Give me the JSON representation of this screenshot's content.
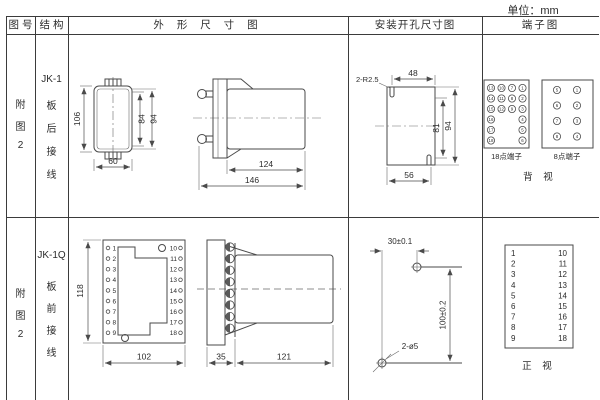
{
  "colors": {
    "line": "#3b3b3b",
    "drawing": "#4a4a4a",
    "text": "#2b2b2b",
    "background": "#ffffff"
  },
  "unit_label": "单位：mm",
  "header": {
    "figure_no": "图 号",
    "structure": "结 构",
    "outline": "外 形 尺 寸 图",
    "mounting": "安装开孔尺寸图",
    "terminal": "端子图"
  },
  "rows": [
    {
      "figure_no": {
        "chars": [
          "附",
          "图",
          "2"
        ]
      },
      "structure": {
        "model": "JK-1",
        "chars": [
          "板",
          "后",
          "接",
          "线"
        ]
      },
      "outline": {
        "front": {
          "dim_height": "106",
          "dim_inner": "84",
          "dim_mid": "94",
          "dim_width": "60"
        },
        "side": {
          "dim_body": "124",
          "dim_total": "146"
        }
      },
      "mounting": {
        "radius_label": "2-R2.5",
        "dim_top": "48",
        "dim_inner": "81",
        "dim_outer": "94",
        "dim_bottom": "56"
      },
      "terminal": {
        "grid18": {
          "label": "18点端子",
          "col1": [
            "13",
            "14",
            "15",
            "16",
            "17",
            "18"
          ],
          "col2": [
            "10",
            "11",
            "12"
          ],
          "col3": [
            "7",
            "8",
            "9"
          ],
          "col4": [
            "1",
            "2",
            "3",
            "4",
            "5",
            "6"
          ]
        },
        "grid8": {
          "label": "8点端子",
          "left": [
            "5",
            "6",
            "7",
            "8"
          ],
          "right": [
            "1",
            "2",
            "3",
            "4"
          ]
        },
        "view_label": "背 视"
      }
    },
    {
      "figure_no": {
        "chars": [
          "附",
          "图",
          "2"
        ]
      },
      "structure": {
        "model": "JK-1Q",
        "chars": [
          "板",
          "前",
          "接",
          "线"
        ]
      },
      "outline": {
        "front": {
          "dim_height": "118",
          "dim_width": "102",
          "left_terms": [
            "1",
            "2",
            "3",
            "4",
            "5",
            "6",
            "7",
            "8",
            "9"
          ],
          "right_terms": [
            "10",
            "11",
            "12",
            "13",
            "14",
            "15",
            "16",
            "17",
            "18"
          ]
        },
        "side": {
          "dim_flange": "35",
          "dim_body": "121"
        }
      },
      "mounting": {
        "dim_horizontal": "30±0.1",
        "dim_vertical": "100±0.2",
        "hole_label": "2-ø5"
      },
      "terminal": {
        "left": [
          "1",
          "2",
          "3",
          "4",
          "5",
          "6",
          "7",
          "8",
          "9"
        ],
        "right": [
          "10",
          "11",
          "12",
          "13",
          "14",
          "15",
          "16",
          "17",
          "18"
        ],
        "view_label": "正 视"
      }
    }
  ]
}
